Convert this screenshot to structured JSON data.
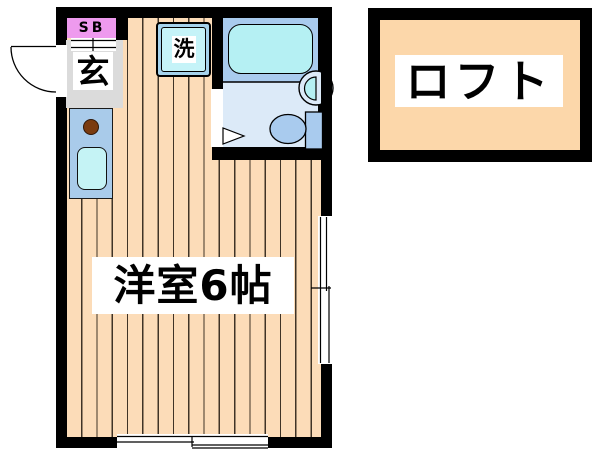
{
  "plan": {
    "shoe_box_label": "SB",
    "entrance_label": "玄",
    "washer_label": "洗",
    "room_label": "洋室6帖"
  },
  "loft": {
    "label": "ロフト"
  },
  "colors": {
    "wall": "#000000",
    "wood_floor": "#FCDCB8",
    "floor_board_line": "#3F3326",
    "genkan_gray": "#DBDBDB",
    "shoe_box_pink": "#EE9AEE",
    "kitchen_blue": "#A9CBEA",
    "kitchen_sink_cyan": "#C5F3F5",
    "burner_brown": "#7A3B10",
    "washer_outer_blue": "#A5D2EC",
    "washer_inner_cyan": "#C5F3F8",
    "bath_upper_blue": "#A9CBEE",
    "bath_lower_blue": "#DCEAF8",
    "bathtub_cyan": "#B5F0F3",
    "fixture_blue": "#A9CBEE",
    "loft_peach": "#FCD7AA",
    "label_bg": "#FFFFFF",
    "text": "#000000"
  }
}
